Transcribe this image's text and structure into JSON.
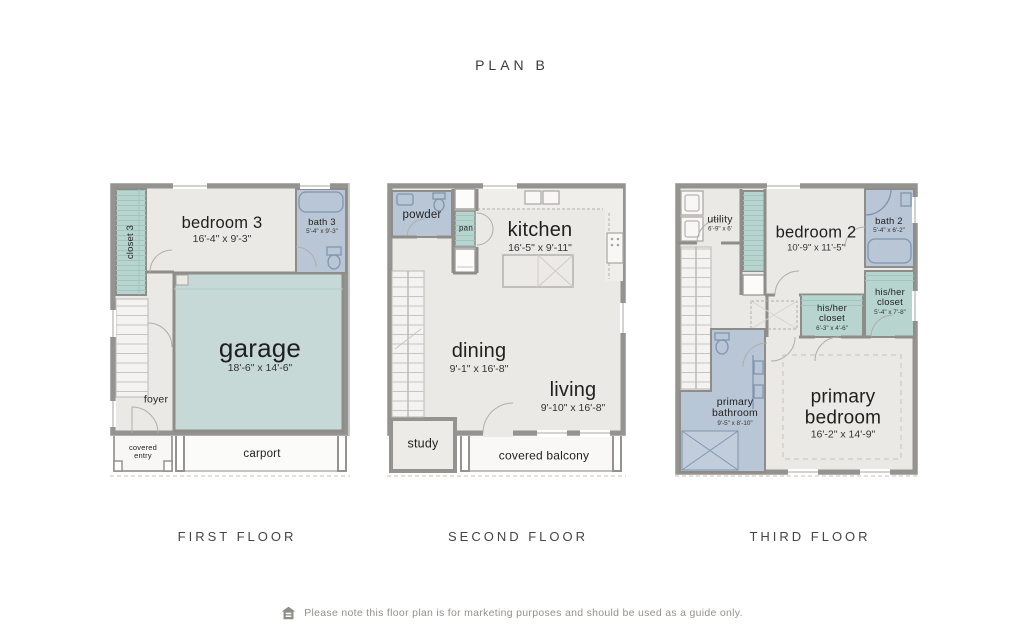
{
  "title": "PLAN B",
  "floors": [
    {
      "label": "FIRST FLOOR",
      "rooms": {
        "closet": {
          "name": "closet 3"
        },
        "bedroom": {
          "name": "bedroom 3",
          "dims": "16'-4\" x 9'-3\""
        },
        "bath": {
          "name": "bath 3",
          "dims": "5'-4\" x 9'-3\""
        },
        "garage": {
          "name": "garage",
          "dims": "18'-6\" x 14'-6\""
        },
        "foyer": {
          "name": "foyer"
        },
        "covered_entry": {
          "name": "covered entry"
        },
        "carport": {
          "name": "carport"
        }
      }
    },
    {
      "label": "SECOND FLOOR",
      "rooms": {
        "powder": {
          "name": "powder"
        },
        "pantry": {
          "name": "pan"
        },
        "kitchen": {
          "name": "kitchen",
          "dims": "16'-5\" x 9'-11\""
        },
        "dining": {
          "name": "dining",
          "dims": "9'-1\" x 16'-8\""
        },
        "living": {
          "name": "living",
          "dims": "9'-10\" x 16'-8\""
        },
        "study": {
          "name": "study"
        },
        "balcony": {
          "name": "covered balcony"
        }
      }
    },
    {
      "label": "THIRD FLOOR",
      "rooms": {
        "utility": {
          "name": "utility",
          "dims": "6'-9\" x 6'"
        },
        "bedroom2": {
          "name": "bedroom 2",
          "dims": "10'-9\" x 11'-5\""
        },
        "bath2": {
          "name": "bath 2",
          "dims": "5'-4\" x 6'-2\""
        },
        "closet_right": {
          "name": "his/her closet",
          "dims": "5'-4\" x 7'-8\""
        },
        "closet_center": {
          "name": "his/her closet",
          "dims": "6'-3\" x 4'-6\""
        },
        "bathroom": {
          "name": "primary bathroom",
          "dims": "9'-5\" x 8'-10\""
        },
        "bedroom": {
          "name": "primary bedroom",
          "dims": "16'-2\" x 14'-9\""
        }
      }
    }
  ],
  "footer": {
    "icon": "equal-housing-icon",
    "note": "Please note this floor plan is for marketing purposes and should be used as a guide only."
  },
  "colors": {
    "garage_teal": "#c7d9d6",
    "closet_teal": "#b8d4cf",
    "bath_blue": "#b9c6d5",
    "floor_gray": "#ebe9e5",
    "wall_gray": "#95938f"
  }
}
